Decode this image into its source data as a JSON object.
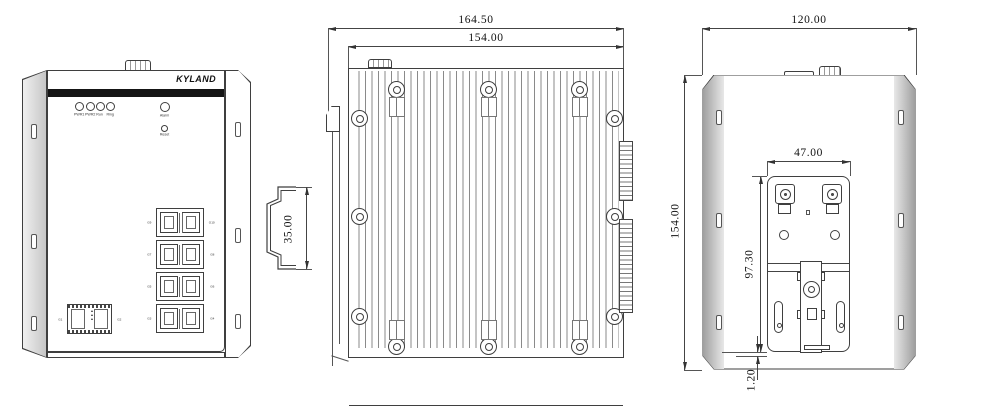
{
  "brand": "KYLAND",
  "front": {
    "leds": [
      "PWR1",
      "PWR2",
      "Run",
      "Ring"
    ],
    "alarm_label": "Alarm",
    "reset_label": "Reset",
    "rj45_rows": [
      {
        "left": "G9",
        "right": "G10"
      },
      {
        "left": "G7",
        "right": "G8"
      },
      {
        "left": "G5",
        "right": "G6"
      },
      {
        "left": "G3",
        "right": "G4"
      }
    ],
    "sfp": {
      "left": "G1",
      "right": "G2",
      "marks": "▲▲▲"
    }
  },
  "side": {
    "dim_overall_width": "164.50",
    "dim_body_width": "154.00"
  },
  "din_rail": {
    "dim_height": "35.00"
  },
  "rear": {
    "dim_width": "120.00",
    "dim_height": "154.00",
    "dim_plate_width": "47.00",
    "dim_plate_height": "97.30",
    "dim_bottom_offset": "1.20"
  },
  "colors": {
    "line": "#3f3f3f",
    "accent_bar": "#151515"
  }
}
